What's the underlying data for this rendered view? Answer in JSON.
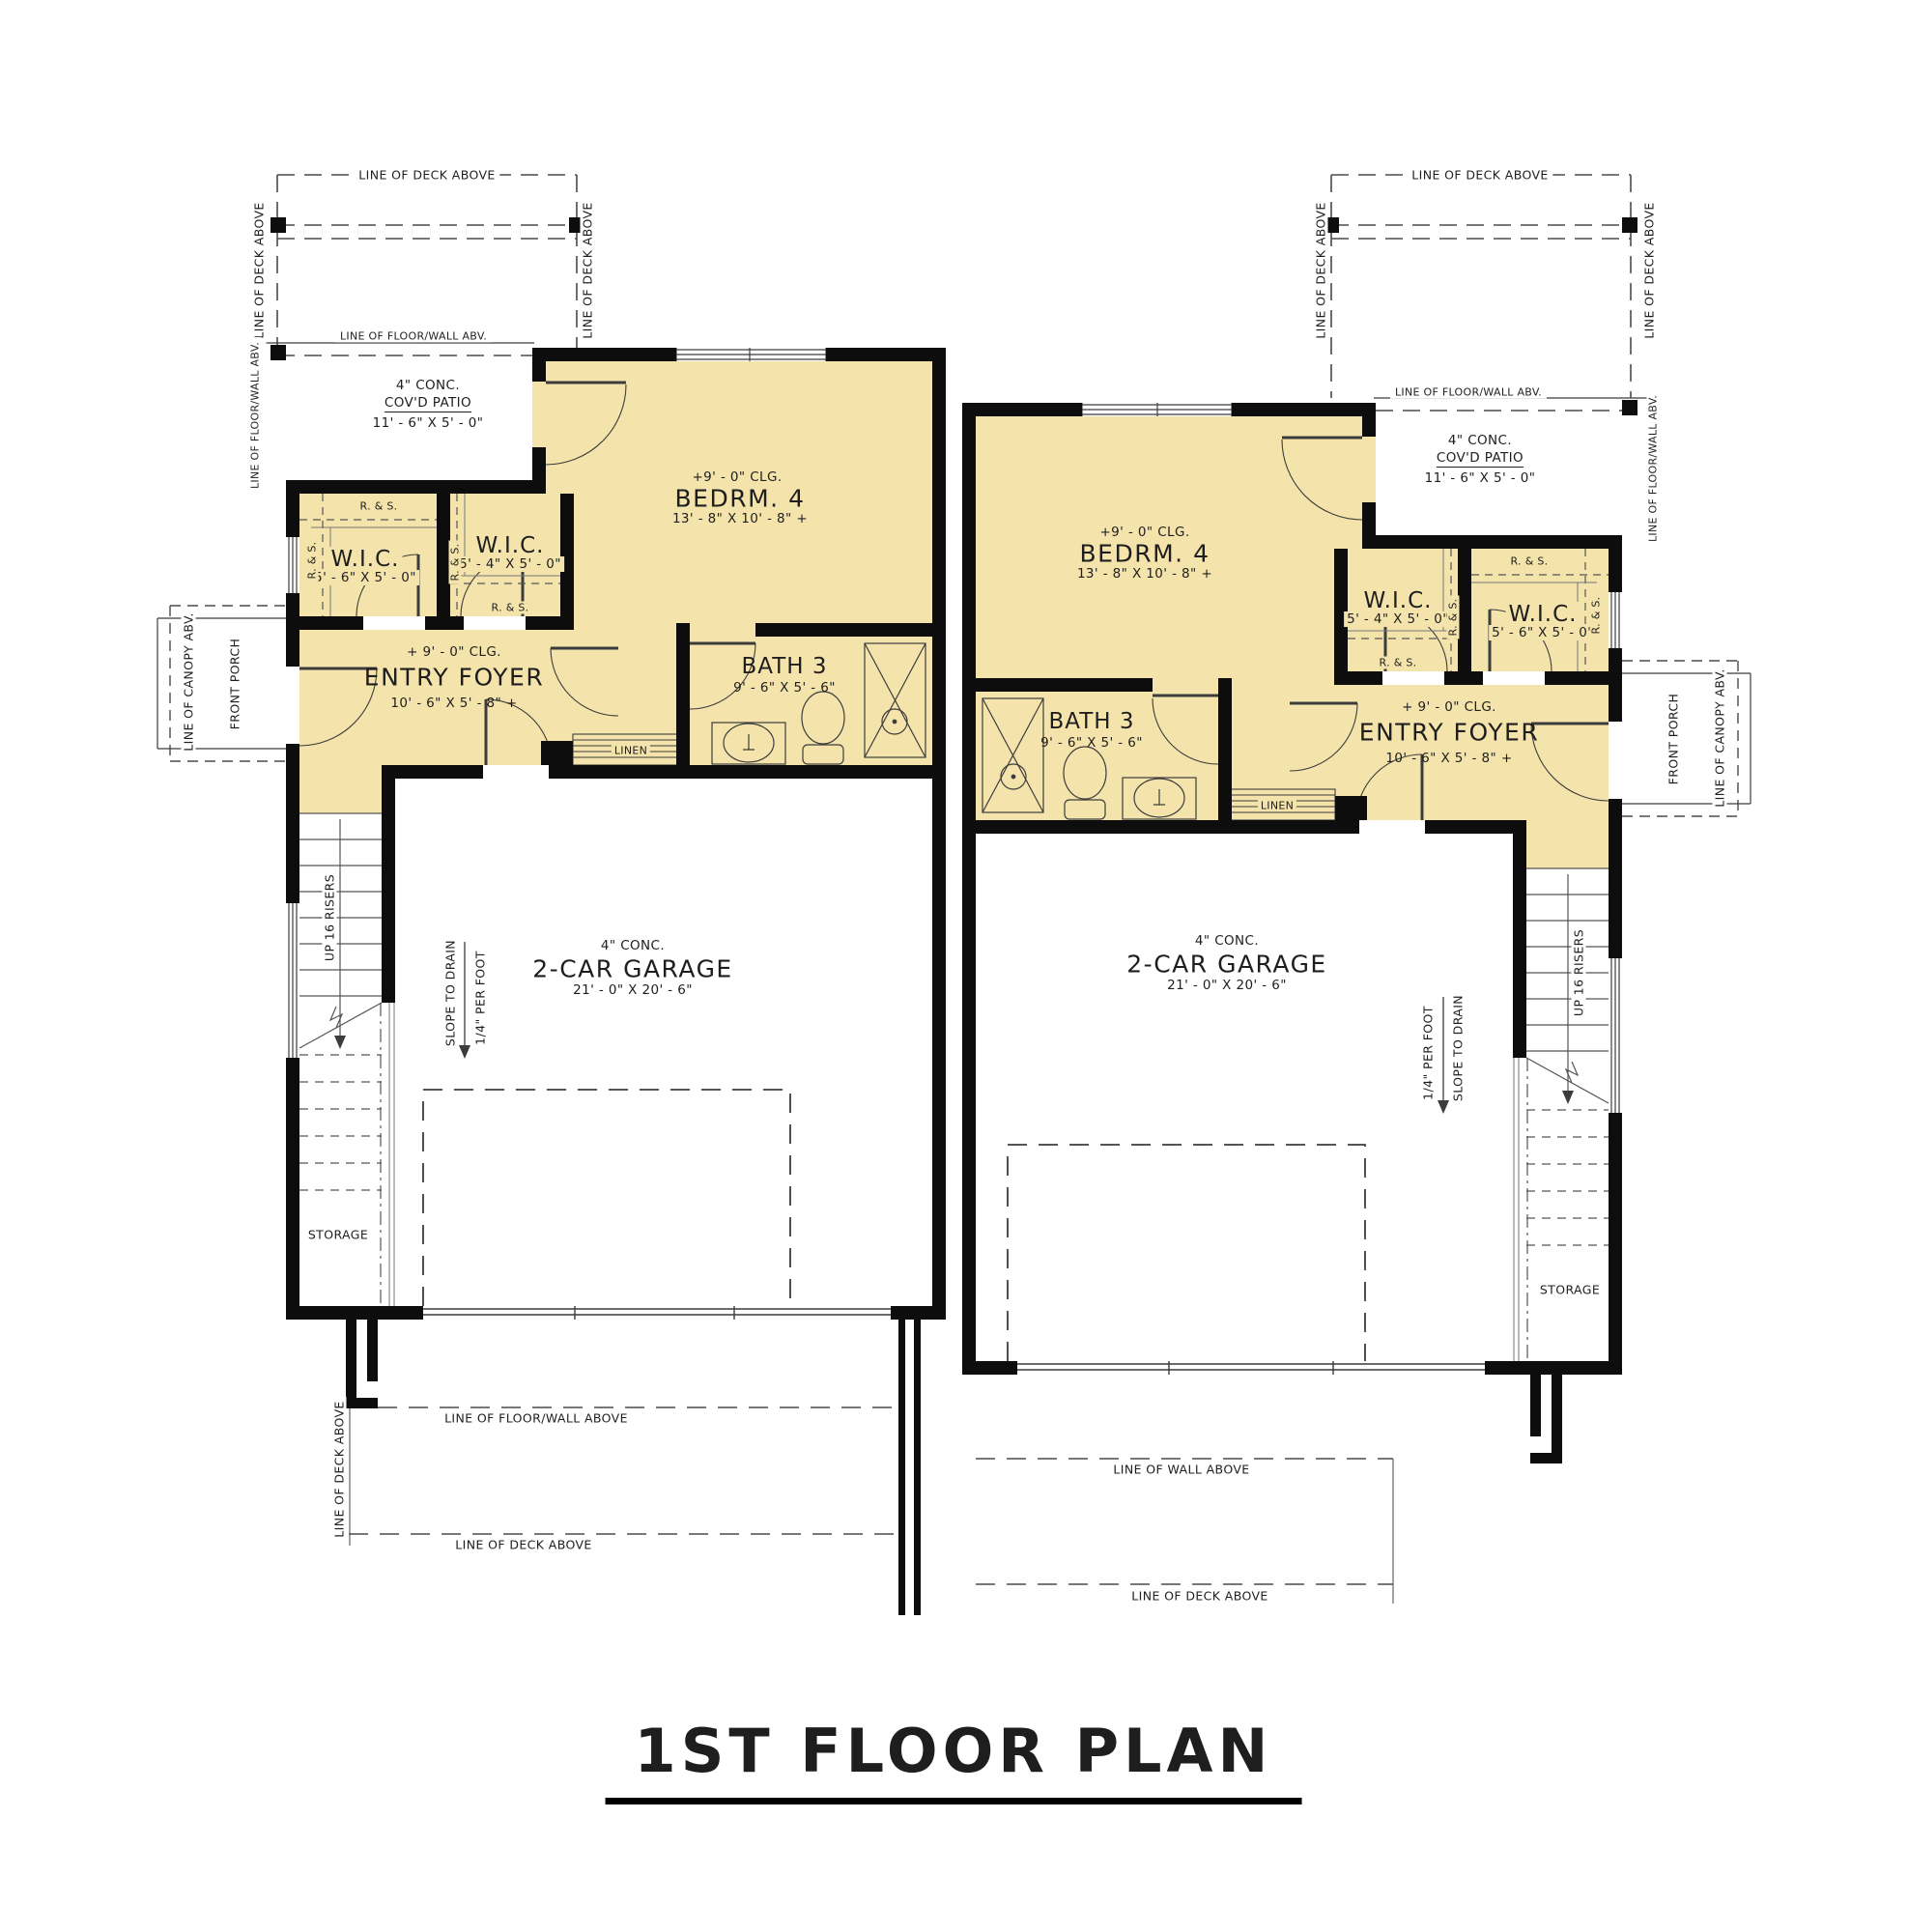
{
  "title": "1ST FLOOR PLAN",
  "unit": {
    "bedroom": {
      "clg": "+9' - 0\" CLG.",
      "name": "BEDRM. 4",
      "dims": "13' - 8\" X 10' - 8\" +"
    },
    "wic": {
      "name": "W.I.C.",
      "dims_a": "5' - 6\" X 5' - 0\"",
      "dims_b": "5' - 4\" X 5' - 0\""
    },
    "entry": {
      "clg": "+ 9' - 0\" CLG.",
      "name": "ENTRY FOYER",
      "dims": "10' - 6\" X 5' - 8\" +"
    },
    "bath": {
      "name": "BATH 3",
      "dims": "9' - 6\" X 5' - 6\""
    },
    "garage": {
      "material": "4\" CONC.",
      "name": "2-CAR GARAGE",
      "dims": "21' - 0\" X 20' - 6\""
    },
    "patio": {
      "material": "4\" CONC.",
      "name": "COV'D PATIO",
      "dims": "11' - 6\" X 5' - 0\""
    },
    "linen": "LINEN",
    "storage": "STORAGE",
    "front_porch": "FRONT PORCH",
    "canopy": "LINE OF CANOPY ABV.",
    "stairs": "UP 16 RISERS",
    "slope_1": "SLOPE TO DRAIN",
    "slope_2": "1/4\" PER FOOT",
    "rod_shelf": "R. & S."
  },
  "annotations": {
    "deck_above": "LINE OF DECK ABOVE",
    "floor_wall_abv": "LINE OF FLOOR/WALL ABV.",
    "floor_wall_above": "LINE OF FLOOR/WALL ABOVE",
    "wall_above": "LINE OF WALL ABOVE"
  },
  "colors": {
    "room_fill": "#f4e4ac",
    "wall": "#0d0d0d",
    "line": "#3c3c3c"
  }
}
